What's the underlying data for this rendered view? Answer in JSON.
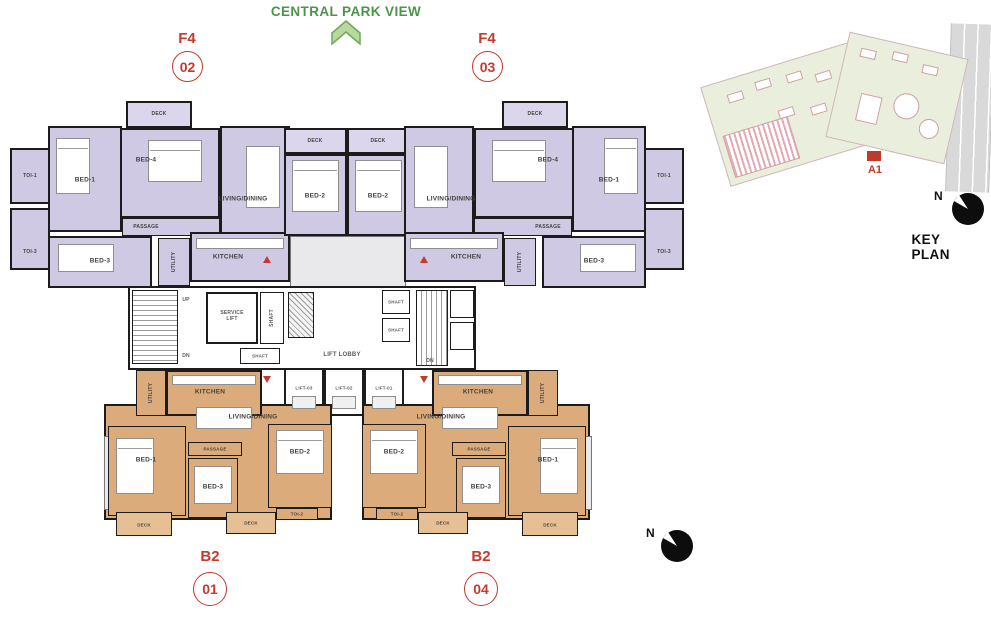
{
  "header": {
    "park_view_label": "CENTRAL PARK VIEW"
  },
  "units": [
    {
      "id": "f4-02",
      "type": "F4",
      "number": "02"
    },
    {
      "id": "f4-03",
      "type": "F4",
      "number": "03"
    },
    {
      "id": "b2-01",
      "type": "B2",
      "number": "01"
    },
    {
      "id": "b2-04",
      "type": "B2",
      "number": "04"
    }
  ],
  "rooms": {
    "bed1": "BED-1",
    "bed2": "BED-2",
    "bed3": "BED-3",
    "bed4": "BED-4",
    "living_dining": "LIVING/DINING",
    "kitchen": "KITCHEN",
    "passage": "PASSAGE",
    "utility": "UTILITY",
    "deck": "DECK",
    "toi1": "TOI-1",
    "toi2": "TOI-2",
    "toi3": "TOI-3",
    "service_lift": "SERVICE LIFT",
    "shaft": "SHAFT",
    "lift_lobby": "LIFT LOBBY",
    "lift_01": "LIFT-01",
    "lift_02": "LIFT-02",
    "lift_03": "LIFT-03",
    "up": "UP",
    "dn": "DN"
  },
  "keyplan": {
    "title": "KEY PLAN",
    "marker_label": "A1",
    "north_label": "N"
  },
  "compass": {
    "north_label": "N"
  },
  "colors": {
    "f4_fill": "#cfc9e4",
    "b2_fill": "#dcab7b",
    "accent_red": "#c23b2c",
    "park_green": "#4a9648",
    "wall": "#1c1c1c"
  }
}
